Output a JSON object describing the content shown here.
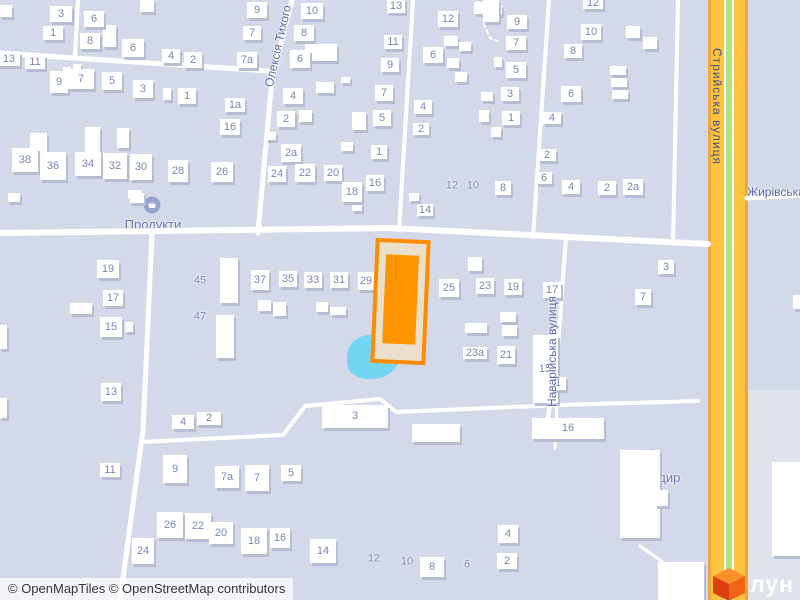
{
  "colors": {
    "background": "#d3d9e9",
    "building": "#ffffff",
    "building_shadow": "#b7bed2",
    "house_number": "#7b86b6",
    "street_label": "#5d6aac",
    "highway_label": "#44508a",
    "road_white": "#ffffff",
    "highway_casing": "#eda63c",
    "highway_fill": "#fbc33e",
    "highway_green_stripe": "#b5e07a",
    "selected_border": "#ff8b00",
    "selected_fill": "#e9dfca",
    "selected_inner": "#ff9300",
    "pond": "#73d6f3",
    "poi_icon_bg": "#98a3cd",
    "area_right_of_highway": "#dfe3ee"
  },
  "attribution": "© OpenMapTiles © OpenStreetMap contributors",
  "logo": {
    "text": "лун"
  },
  "pois": [
    {
      "label": "Продукти",
      "cx": 153,
      "cy": 217,
      "icon_cx": 152,
      "icon_cy": 205
    },
    {
      "label": "Бригадир",
      "cx": 652,
      "cy": 470,
      "icon_cx": 652,
      "icon_cy": 458
    }
  ],
  "streets": [
    {
      "name": "Олексія Тихого",
      "type": "diagonal",
      "cx": 278,
      "cy": 46,
      "angle": -77
    },
    {
      "name": "Стрийська вулиця",
      "type": "vertical-down",
      "cx": 717,
      "cy": 106,
      "height": 184,
      "color": "#44508a"
    },
    {
      "name": "Наварійська вулиця",
      "type": "vertical-up",
      "cx": 552,
      "cy": 352,
      "height": 178
    },
    {
      "name": "Жирівська вулиця",
      "type": "horizontal",
      "x": 747,
      "y": 185
    }
  ],
  "selected_building": {
    "x": 373,
    "y": 239,
    "w": 47,
    "h": 117,
    "angle": 2.5,
    "inner_inset": [
      12,
      7,
      16,
      7
    ]
  },
  "pond": {
    "x": 347,
    "y": 335,
    "w": 53,
    "h": 44
  },
  "areas": [
    {
      "x": 748,
      "y": 390,
      "w": 52,
      "h": 210
    }
  ],
  "labeled_buildings": [
    [
      "3",
      61,
      14,
      22,
      16
    ],
    [
      "6",
      94,
      19,
      20,
      16
    ],
    [
      "1",
      53,
      33,
      20,
      14
    ],
    [
      "8",
      90,
      41,
      20,
      16
    ],
    [
      "6",
      133,
      48,
      22,
      18
    ],
    [
      "4",
      171,
      56,
      18,
      14
    ],
    [
      "2",
      193,
      60,
      18,
      16
    ],
    [
      "13",
      9,
      59,
      22,
      14
    ],
    [
      "11",
      35,
      62,
      20,
      14
    ],
    [
      "9",
      59,
      82,
      18,
      22
    ],
    [
      "7",
      81,
      79,
      26,
      20
    ],
    [
      "5",
      112,
      81,
      20,
      18
    ],
    [
      "3",
      143,
      89,
      20,
      18
    ],
    [
      "1",
      187,
      96,
      18,
      16
    ],
    [
      "9",
      257,
      10,
      20,
      16
    ],
    [
      "7",
      252,
      33,
      18,
      14
    ],
    [
      "7а",
      247,
      60,
      20,
      16
    ],
    [
      "1а",
      235,
      105,
      20,
      14
    ],
    [
      "16",
      230,
      127,
      20,
      16
    ],
    [
      "38",
      25,
      160,
      26,
      24
    ],
    [
      "36",
      53,
      166,
      26,
      28
    ],
    [
      "34",
      88,
      164,
      26,
      24
    ],
    [
      "32",
      115,
      166,
      24,
      26
    ],
    [
      "30",
      141,
      167,
      22,
      26
    ],
    [
      "28",
      178,
      171,
      20,
      22
    ],
    [
      "26",
      222,
      172,
      22,
      20
    ],
    [
      "10",
      312,
      11,
      22,
      16
    ],
    [
      "8",
      304,
      33,
      20,
      16
    ],
    [
      "6",
      300,
      59,
      20,
      18
    ],
    [
      "4",
      293,
      96,
      20,
      16
    ],
    [
      "2",
      286,
      119,
      18,
      16
    ],
    [
      "2а",
      291,
      153,
      20,
      18
    ],
    [
      "24",
      277,
      174,
      18,
      16
    ],
    [
      "22",
      305,
      173,
      20,
      18
    ],
    [
      "20",
      333,
      173,
      18,
      16
    ],
    [
      "18",
      352,
      192,
      20,
      20
    ],
    [
      "16",
      375,
      183,
      18,
      16
    ],
    [
      "13",
      396,
      6,
      18,
      14
    ],
    [
      "11",
      393,
      42,
      18,
      14
    ],
    [
      "9",
      390,
      65,
      18,
      14
    ],
    [
      "7",
      384,
      93,
      18,
      16
    ],
    [
      "5",
      382,
      118,
      18,
      16
    ],
    [
      "1",
      379,
      152,
      16,
      14
    ],
    [
      "12",
      448,
      19,
      20,
      16
    ],
    [
      "6",
      433,
      55,
      20,
      16
    ],
    [
      "4",
      423,
      107,
      18,
      14
    ],
    [
      "2",
      421,
      129,
      16,
      12
    ],
    [
      "14",
      425,
      210,
      16,
      12
    ],
    [
      "8",
      503,
      188,
      16,
      14
    ],
    [
      "9",
      517,
      22,
      20,
      14
    ],
    [
      "7",
      516,
      43,
      20,
      14
    ],
    [
      "5",
      516,
      70,
      20,
      16
    ],
    [
      "3",
      510,
      94,
      18,
      14
    ],
    [
      "1",
      511,
      118,
      18,
      14
    ],
    [
      "12",
      593,
      3,
      20,
      12
    ],
    [
      "10",
      591,
      32,
      20,
      16
    ],
    [
      "8",
      573,
      51,
      18,
      14
    ],
    [
      "6",
      571,
      94,
      20,
      16
    ],
    [
      "4",
      552,
      118,
      18,
      12
    ],
    [
      "2",
      547,
      155,
      18,
      12
    ],
    [
      "6",
      544,
      178,
      16,
      12
    ],
    [
      "4",
      571,
      187,
      18,
      14
    ],
    [
      "2",
      607,
      188,
      18,
      14
    ],
    [
      "2а",
      633,
      187,
      20,
      16
    ],
    [
      "19",
      108,
      269,
      22,
      18
    ],
    [
      "17",
      113,
      298,
      20,
      16
    ],
    [
      "15",
      111,
      327,
      22,
      20
    ],
    [
      "13",
      111,
      392,
      20,
      18
    ],
    [
      "11",
      110,
      470,
      20,
      14
    ],
    [
      "37",
      260,
      280,
      18,
      20
    ],
    [
      "35",
      288,
      279,
      18,
      16
    ],
    [
      "33",
      313,
      280,
      18,
      16
    ],
    [
      "31",
      339,
      280,
      18,
      16
    ],
    [
      "29",
      366,
      281,
      16,
      18
    ],
    [
      "25",
      449,
      288,
      20,
      18
    ],
    [
      "23",
      485,
      286,
      18,
      16
    ],
    [
      "19",
      513,
      287,
      18,
      16
    ],
    [
      "17",
      552,
      290,
      18,
      16
    ],
    [
      "23а",
      475,
      353,
      24,
      12
    ],
    [
      "21",
      506,
      355,
      18,
      18
    ],
    [
      "15",
      545,
      369,
      25,
      68
    ],
    [
      "3",
      666,
      267,
      16,
      14
    ],
    [
      "7",
      643,
      297,
      16,
      16
    ],
    [
      "4",
      183,
      422,
      22,
      14
    ],
    [
      "2",
      209,
      418,
      24,
      13
    ],
    [
      "3",
      355,
      416,
      66,
      23
    ],
    [
      "9",
      175,
      469,
      24,
      28
    ],
    [
      "7а",
      227,
      477,
      24,
      22
    ],
    [
      "7",
      257,
      478,
      24,
      26
    ],
    [
      "5",
      291,
      473,
      20,
      16
    ],
    [
      "26",
      170,
      525,
      26,
      26
    ],
    [
      "22",
      198,
      526,
      26,
      26
    ],
    [
      "20",
      221,
      533,
      24,
      22
    ],
    [
      "18",
      254,
      541,
      26,
      26
    ],
    [
      "16",
      280,
      538,
      20,
      20
    ],
    [
      "24",
      143,
      551,
      22,
      26
    ],
    [
      "14",
      323,
      551,
      26,
      24
    ],
    [
      "8",
      432,
      567,
      24,
      20
    ],
    [
      "1",
      558,
      383,
      16,
      13
    ],
    [
      "16",
      568,
      428,
      72,
      21
    ],
    [
      "4",
      508,
      534,
      20,
      18
    ],
    [
      "2",
      507,
      561,
      20,
      16
    ]
  ],
  "number_floats": [
    [
      "45",
      200,
      281
    ],
    [
      "47",
      200,
      317
    ],
    [
      "12",
      452,
      186
    ],
    [
      "10",
      473,
      186
    ],
    [
      "12",
      374,
      559
    ],
    [
      "10",
      407,
      562
    ],
    [
      "6",
      467,
      565
    ]
  ],
  "plain_buildings": [
    [
      0,
      5,
      12,
      12
    ],
    [
      103,
      25,
      13,
      22
    ],
    [
      140,
      0,
      14,
      12
    ],
    [
      85,
      127,
      15,
      28
    ],
    [
      30,
      133,
      17,
      22
    ],
    [
      117,
      128,
      12,
      20
    ],
    [
      63,
      67,
      8,
      7
    ],
    [
      73,
      64,
      8,
      7
    ],
    [
      163,
      88,
      8,
      12
    ],
    [
      128,
      190,
      13,
      9
    ],
    [
      8,
      193,
      12,
      9
    ],
    [
      130,
      193,
      14,
      10
    ],
    [
      305,
      44,
      32,
      17
    ],
    [
      316,
      82,
      18,
      11
    ],
    [
      299,
      110,
      13,
      12
    ],
    [
      341,
      77,
      9,
      6
    ],
    [
      352,
      112,
      14,
      18
    ],
    [
      341,
      142,
      12,
      9
    ],
    [
      266,
      132,
      10,
      8
    ],
    [
      352,
      203,
      10,
      8
    ],
    [
      409,
      193,
      10,
      8
    ],
    [
      444,
      36,
      14,
      10
    ],
    [
      459,
      42,
      12,
      9
    ],
    [
      447,
      58,
      12,
      10
    ],
    [
      455,
      72,
      12,
      10
    ],
    [
      481,
      92,
      12,
      9
    ],
    [
      479,
      110,
      10,
      12
    ],
    [
      474,
      2,
      16,
      12
    ],
    [
      490,
      5,
      12,
      10
    ],
    [
      494,
      57,
      8,
      10
    ],
    [
      491,
      127,
      10,
      10
    ],
    [
      483,
      0,
      16,
      22
    ],
    [
      610,
      66,
      16,
      9
    ],
    [
      611,
      78,
      16,
      9
    ],
    [
      612,
      90,
      16,
      9
    ],
    [
      626,
      26,
      14,
      12
    ],
    [
      643,
      37,
      14,
      12
    ],
    [
      220,
      258,
      18,
      45
    ],
    [
      216,
      315,
      18,
      43
    ],
    [
      258,
      300,
      13,
      11
    ],
    [
      273,
      302,
      13,
      14
    ],
    [
      316,
      302,
      12,
      10
    ],
    [
      330,
      307,
      16,
      8
    ],
    [
      465,
      323,
      22,
      10
    ],
    [
      500,
      312,
      16,
      10
    ],
    [
      502,
      325,
      15,
      11
    ],
    [
      468,
      257,
      14,
      14
    ],
    [
      70,
      303,
      22,
      11
    ],
    [
      125,
      322,
      8,
      10
    ],
    [
      0,
      325,
      7,
      24
    ],
    [
      0,
      398,
      7,
      20
    ],
    [
      620,
      450,
      40,
      88
    ],
    [
      655,
      490,
      13,
      16
    ],
    [
      412,
      424,
      48,
      18
    ],
    [
      772,
      462,
      28,
      94
    ],
    [
      658,
      562,
      46,
      38
    ],
    [
      793,
      295,
      7,
      14
    ]
  ],
  "roads": {
    "white": [
      {
        "pts": [
          [
            0,
            53
          ],
          [
            268,
            71
          ]
        ],
        "w": 5
      },
      {
        "pts": [
          [
            78,
            0
          ],
          [
            75,
            56
          ]
        ],
        "w": 4
      },
      {
        "pts": [
          [
            292,
            0
          ],
          [
            272,
            78
          ],
          [
            258,
            233
          ]
        ],
        "w": 5
      },
      {
        "pts": [
          [
            0,
            233
          ],
          [
            390,
            228
          ],
          [
            708,
            244
          ]
        ],
        "w": 6
      },
      {
        "pts": [
          [
            152,
            234
          ],
          [
            143,
            430
          ],
          [
            120,
            600
          ]
        ],
        "w": 5
      },
      {
        "pts": [
          [
            413,
            0
          ],
          [
            399,
            230
          ]
        ],
        "w": 4
      },
      {
        "pts": [
          [
            549,
            0
          ],
          [
            533,
            237
          ]
        ],
        "w": 4
      },
      {
        "pts": [
          [
            678,
            0
          ],
          [
            673,
            244
          ]
        ],
        "w": 4
      },
      {
        "pts": [
          [
            747,
            198
          ],
          [
            800,
            195
          ]
        ],
        "w": 5
      },
      {
        "pts": [
          [
            141,
            442
          ],
          [
            283,
            435
          ],
          [
            305,
            406
          ],
          [
            380,
            399
          ],
          [
            396,
            412
          ],
          [
            560,
            405
          ],
          [
            698,
            401
          ]
        ],
        "w": 4
      },
      {
        "pts": [
          [
            566,
            237
          ],
          [
            558,
            345
          ],
          [
            548,
            418
          ]
        ],
        "w": 4
      },
      {
        "pts": [
          [
            557,
            405
          ],
          [
            555,
            448
          ]
        ],
        "w": 3
      },
      {
        "pts": [
          [
            640,
            546
          ],
          [
            667,
            565
          ],
          [
            673,
            600
          ]
        ],
        "w": 3
      }
    ],
    "dotted": [
      {
        "pts": [
          [
            484,
            24
          ],
          [
            490,
            38
          ],
          [
            500,
            42
          ]
        ],
        "w": 2
      }
    ],
    "highway": {
      "x": 728,
      "casing_w": 40,
      "fill_w": 34,
      "stripe_outer_w": 10,
      "stripe_inner_w": 6
    }
  }
}
